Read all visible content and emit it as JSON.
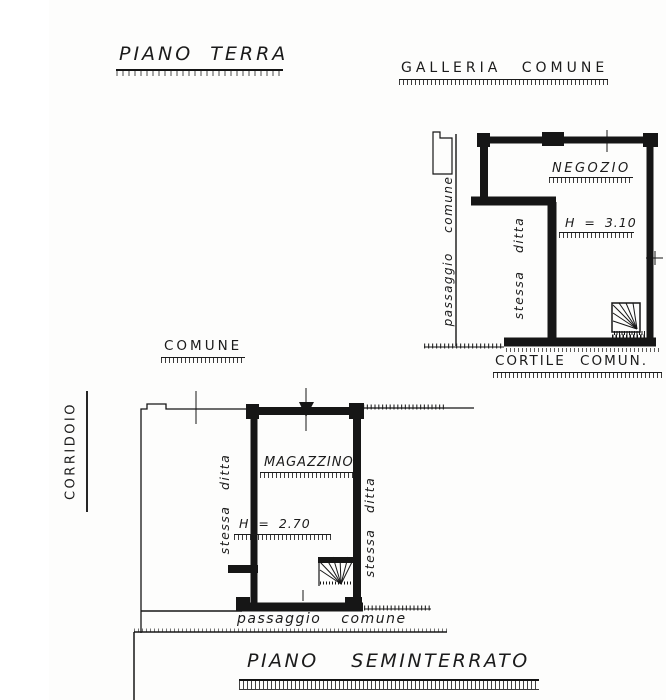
{
  "page": {
    "background": "#fdfdfc",
    "ink": "#1b1b1b"
  },
  "floors": {
    "terra": {
      "title": "PIANO TERRA",
      "area_label": "GALLERIA COMUNE",
      "room": "NEGOZIO",
      "height": "H = 3.10",
      "left_boundary": "passaggio comune",
      "side_strip": "stessa ditta",
      "bottom_label": "CORTILE COMUN."
    },
    "seminterrato": {
      "title": "PIANO SEMINTERRATO",
      "area_label": "COMUNE",
      "corridor": "CORRIDOIO",
      "room": "MAGAZZINO",
      "height": "H = 2.70",
      "left_strip": "stessa ditta",
      "right_strip": "stessa ditta",
      "bottom_boundary": "passaggio comune"
    }
  },
  "icons": {
    "stairs": "winder-stairs-icon"
  }
}
